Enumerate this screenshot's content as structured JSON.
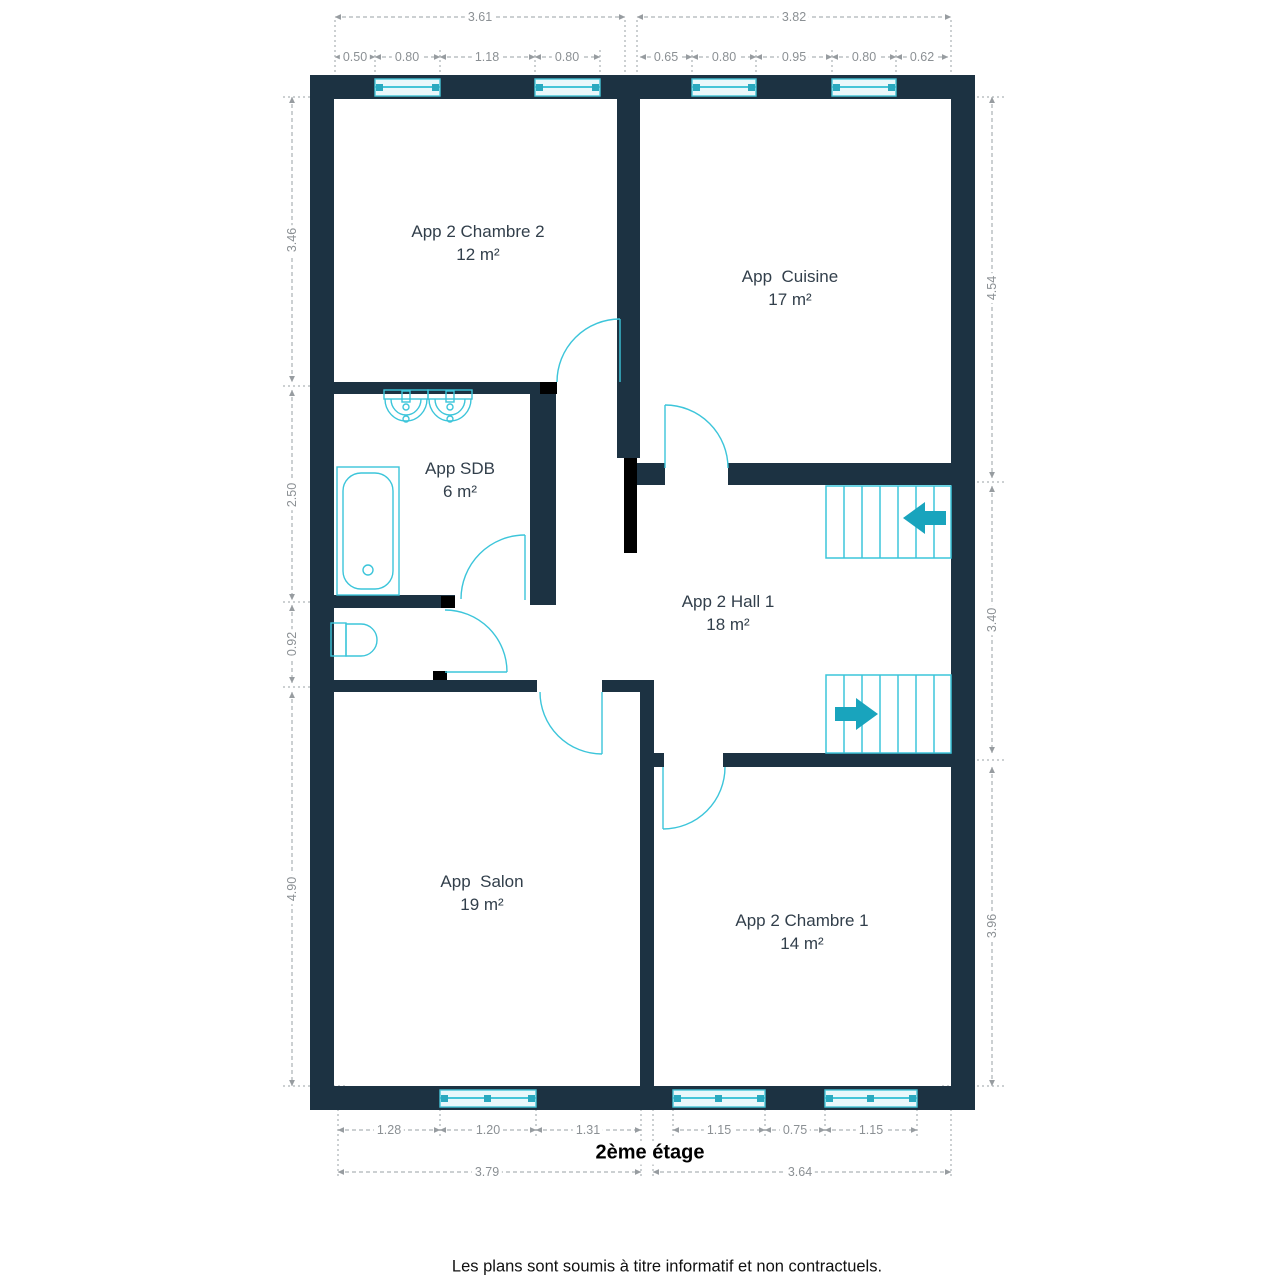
{
  "title": "2ème étage",
  "footer": "Les plans sont soumis à titre informatif et non contractuels.",
  "rooms": [
    {
      "name": "App 2 Chambre 2",
      "area": "12 m²"
    },
    {
      "name": "App  Cuisine",
      "area": "17 m²"
    },
    {
      "name": "App SDB",
      "area": "6 m²"
    },
    {
      "name": "App 2 Hall 1",
      "area": "18 m²"
    },
    {
      "name": "App  Salon",
      "area": "19 m²"
    },
    {
      "name": "App 2 Chambre 1",
      "area": "14 m²"
    }
  ],
  "dims": {
    "top_totals": [
      "3.61",
      "3.82"
    ],
    "top_left_segments": [
      "0.50",
      "0.80",
      "1.18",
      "0.80"
    ],
    "top_right_segments": [
      "0.65",
      "0.80",
      "0.95",
      "0.80",
      "0.62"
    ],
    "left": [
      "3.46",
      "2.50",
      "0.92",
      "4.90"
    ],
    "right": [
      "4.54",
      "3.40",
      "3.96"
    ],
    "bottom_left_segments": [
      "1.28",
      "1.20",
      "1.31"
    ],
    "bottom_right_segments": [
      "1.15",
      "0.75",
      "1.15"
    ],
    "bottom_totals": [
      "3.79",
      "3.64"
    ]
  },
  "colors": {
    "wall": "#1c3242",
    "fixture_cyan": "#3cc5da",
    "stair_arrow": "#19a4bd",
    "dimension_gray": "#8b9094",
    "label_text": "#323f4b"
  }
}
